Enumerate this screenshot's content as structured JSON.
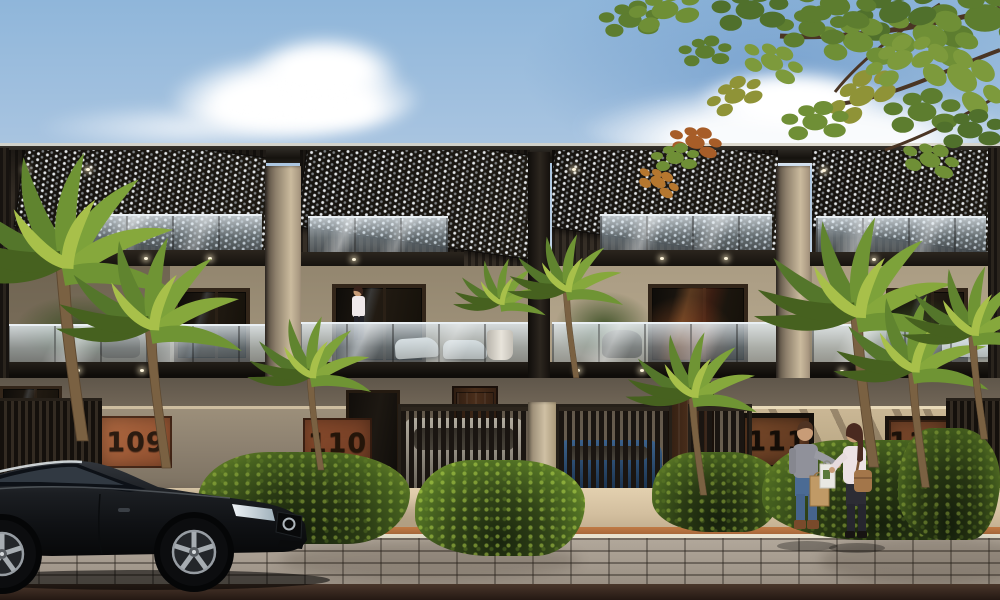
{
  "scene": {
    "description": "Daytime street view of modern two-storey row houses with rooftop pergola screens, glass balconies, tropical landscaping, a parked black sedan and two pedestrians talking"
  },
  "houses": [
    {
      "number": "109"
    },
    {
      "number": "110"
    },
    {
      "number": "111"
    },
    {
      "number": "112"
    }
  ],
  "colors": {
    "sky_top": "#8fb6da",
    "sky_horizon": "#f4eede",
    "cloud": "#ffffff",
    "roof_beam": "#211d18",
    "screen_panel": "#16130f",
    "screen_dots": "#eef2f6",
    "upper_wall": "#978a77",
    "sunlit_wall": "#cab795",
    "shaded_wall": "#6e6356",
    "pillar": "#cbbb9e",
    "window_frame": "#33261a",
    "window_glass": "#15110d",
    "glass_railing": "#b9cdd9",
    "fascia": "#1c1814",
    "compound_wall": "#8d8170",
    "plaque_109": "#a9653e",
    "plaque_110": "#8a4c2d",
    "plaque_111": "#7a4a2a",
    "plaque_112": "#7e4a2c",
    "plaque_number": "#2b1b10",
    "gate": "#1a1511",
    "foliage_dark": "#2a3a14",
    "foliage_light": "#7f9c33",
    "palm": "#54762b",
    "sidewalk": "#d6c2a3",
    "curb_accent": "#b5713f",
    "paver": "#a59a8e",
    "road": "#3a2b21",
    "sedan_black": "#111316",
    "suv_white": "#cfc9bb",
    "car_blue": "#336099",
    "skin": "#c89c77",
    "man_sweater": "#90919a",
    "man_jeans": "#4b6b94",
    "woman_blouse": "#ece2e4",
    "woman_bag": "#a3764a"
  },
  "entities": {
    "vehicle_foreground": "black-sedan",
    "vehicles_behind_gates": [
      "white-suv",
      "blue-car"
    ],
    "pedestrians": [
      "man-grey-sweater",
      "woman-with-bags"
    ],
    "balcony_person": "woman-on-balcony",
    "vegetation": [
      "palm-trees",
      "hedge-shrubs",
      "overhanging-tree-canopy"
    ]
  }
}
